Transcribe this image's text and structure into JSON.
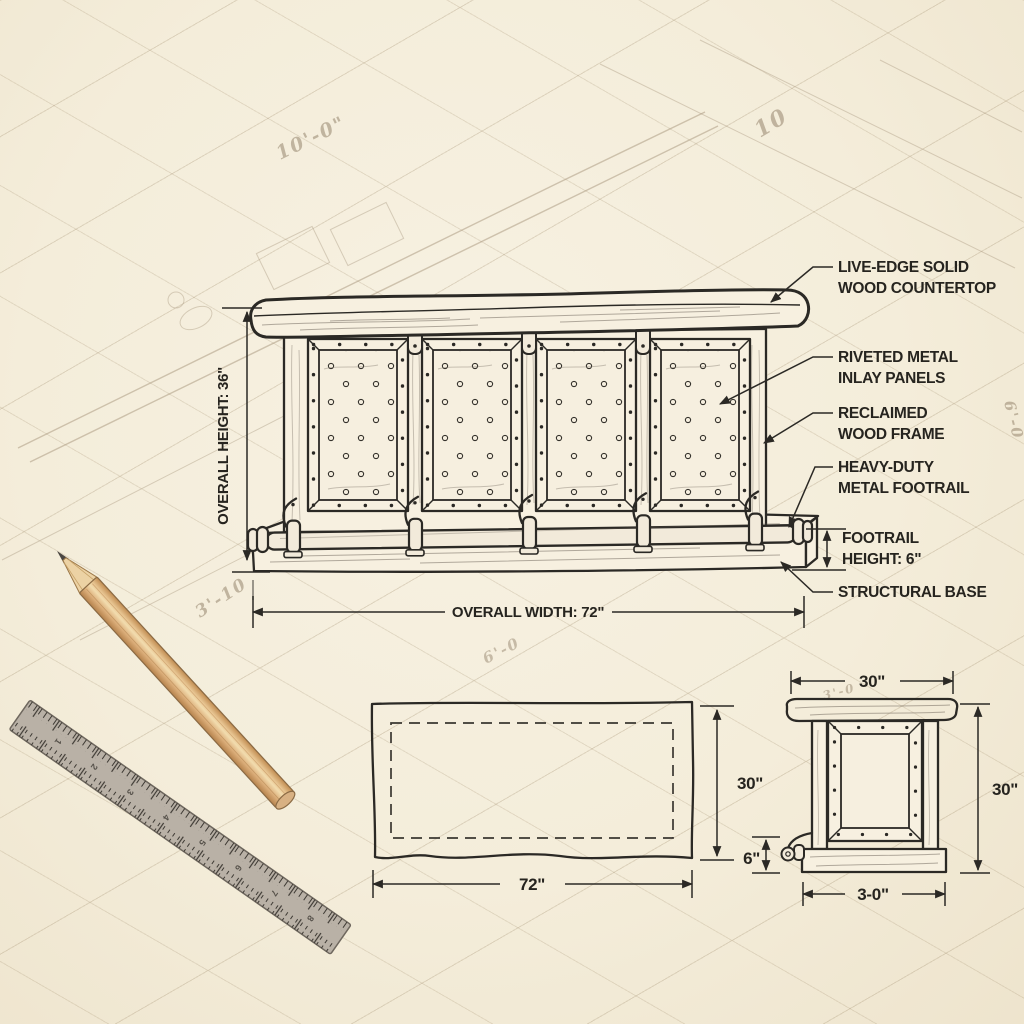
{
  "elevation": {
    "dimensions": {
      "overall_height": "OVERALL HEIGHT: 36\"",
      "overall_width": "OVERALL WIDTH: 72\""
    },
    "callouts": {
      "countertop": [
        "LIVE-EDGE SOLID",
        "WOOD COUNTERTOP"
      ],
      "panels": [
        "RIVETED METAL",
        "INLAY PANELS"
      ],
      "frame": [
        "RECLAIMED",
        "WOOD FRAME"
      ],
      "footrail": [
        "HEAVY-DUTY",
        "METAL FOOTRAIL"
      ],
      "footrail_height": [
        "FOOTRAIL",
        "HEIGHT: 6\""
      ],
      "base": [
        "STRUCTURAL BASE"
      ]
    },
    "panel_count": 4
  },
  "plan_view": {
    "width_dim": "72\"",
    "depth_dim": "30\""
  },
  "side_view": {
    "top_width_dim": "30\"",
    "height_dim": "30\"",
    "footrail_height_dim": "6\"",
    "base_width_dim": "3-0\""
  },
  "sketch_annotations": {
    "a1": "10'-0\"",
    "a2": "10",
    "a3": "3'-10",
    "a4": "6'-0",
    "a5": "6'-0",
    "a6": "3'-0"
  },
  "ruler": {
    "numbers": [
      "1",
      "2",
      "3",
      "4",
      "5",
      "6",
      "7",
      "8"
    ]
  },
  "colors": {
    "paper": "#f4edda",
    "ink": "#2b2925",
    "faint_pencil": "#a5937a",
    "pencil_wood": "#e2bc86",
    "ruler_gray": "#b9b1a6"
  }
}
